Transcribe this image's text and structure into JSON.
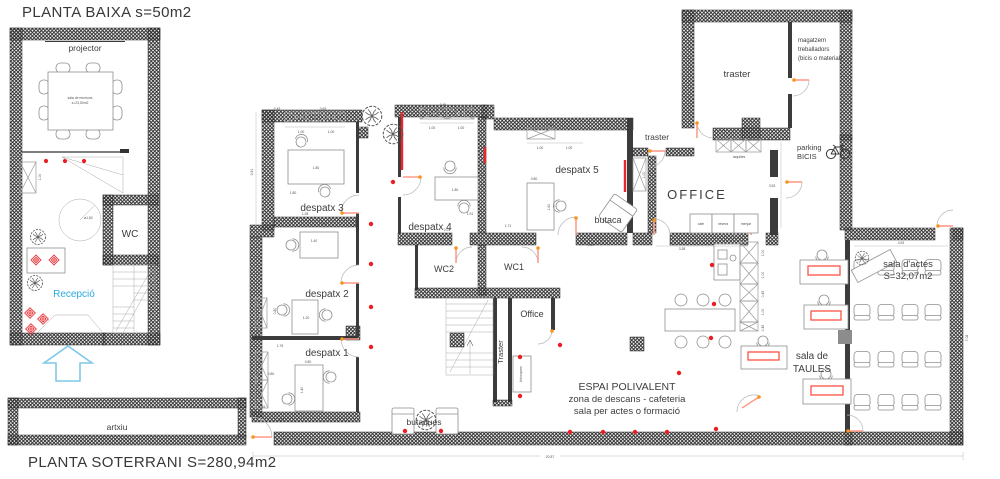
{
  "titles": {
    "baixa": "PLANTA BAIXA s=50m2",
    "soterrani": "PLANTA SOTERRANI S=280,94m2"
  },
  "ground_floor": {
    "projector": "projector",
    "table_note1": "sala de reunions",
    "table_note2": "s=23,50m2",
    "wc": "WC",
    "recepcio": "Recepció"
  },
  "basement": {
    "despatx1": "despatx 1",
    "despatx2": "despatx 2",
    "despatx3": "despatx 3",
    "despatx4": "despatx 4",
    "despatx5": "despatx 5",
    "wc1": "WC1",
    "wc2": "WC2",
    "office_room": "Office",
    "office_main": "OFFICE",
    "traster_ne": "traster",
    "traster_small": "traster",
    "traster_shaft": "Traster",
    "magatzem1": "magatzem",
    "magatzem2": "treballadors",
    "magatzem3": "(bicis o material)",
    "parking1": "parking",
    "parking2": "BICIS",
    "taquilles": "taquilles",
    "fotocopies": "fotocopies",
    "counter": {
      "cafe": "cafe",
      "nevera": "nevera",
      "menjar": "menjar"
    },
    "butaca": "butaca",
    "butaques": "butaques",
    "sala_taules1": "sala de",
    "sala_taules2": "TAULES",
    "sala_actes1": "sala d'actes",
    "sala_actes2": "S=32,07m2",
    "artxiu": "artxiu",
    "espai1": "ESPAI POLIVALENT",
    "espai2": "zona de descans - cafeteria",
    "espai3": "sala per actes o formació"
  },
  "dimensions": {
    "gf_box": "1.00",
    "gf_circle": "ø1,50",
    "d3_a": "0.45",
    "d3_b": "0.65",
    "d3_c": "1.00",
    "d3_d": "1.00",
    "d3_h": "3.91",
    "d3_desk_w": "1.80",
    "d3_desk_h": "1.80",
    "d3_e": "1.28",
    "d3_f": "0.70",
    "d2_top": "1.40",
    "d2_shelf": "0.80",
    "d2_shelf2": "0.45",
    "d2_desk": "1.20",
    "d2_w": "1.76",
    "d1_a": "0.80",
    "d1_desk": "1.40",
    "d1_shelf": "0.80",
    "d1_shelf2": "0.45",
    "d1_w": "1.84",
    "d4_a": "0.45",
    "d4_b": "1.00",
    "d4_c": "1.00",
    "d4_desk_w": "1.80",
    "d4_desk_h": "1.91",
    "d4_w": "2.01",
    "d5_a": "0.45",
    "d5_b": "1.00",
    "d5_c": "1.00",
    "d5_d": "0.80",
    "d5_e": "1.60",
    "d5_f": "1.71",
    "d5_g": "2.50",
    "shaft_h": "1.00",
    "office_e": "3.53",
    "office_s": "3.38",
    "tq_a": "1.00",
    "tq_b": "1.00",
    "tq_c": "0.45",
    "tq_d": "1.00",
    "tq_e": "0.45",
    "actes_n": "4.53",
    "actes_e": "7.08",
    "total_w": "20.87"
  },
  "colors": {
    "accent_red": "#ed1c24",
    "accent_blue": "#29abe2",
    "door_orange": "#f7931e",
    "leaf_pink": "#ff9c8a",
    "table_red": "#ff5044",
    "wall_dark": "#3b3b3b"
  }
}
